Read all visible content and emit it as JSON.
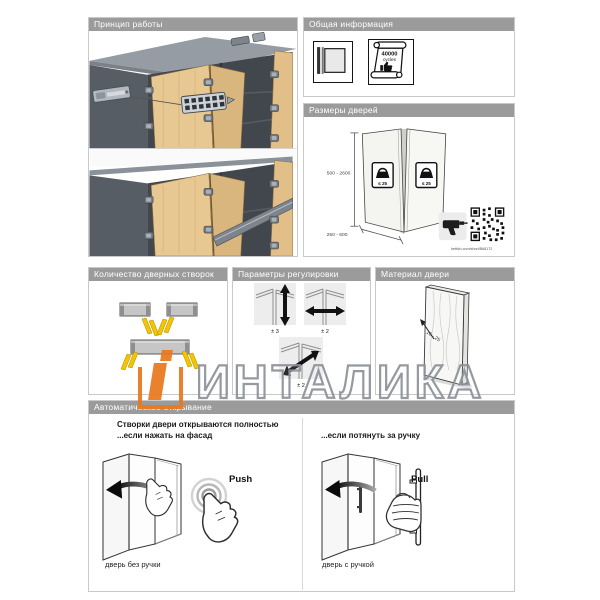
{
  "watermark": {
    "text": "ИНТАЛИКА"
  },
  "panels": {
    "principle": {
      "title": "Принцип работы"
    },
    "general": {
      "title": "Общая информация",
      "cycles_value": "40000",
      "cycles_unit": "cycles"
    },
    "sizes": {
      "title": "Размеры дверей",
      "height_range": "500 - 2600",
      "width_range": "250 - 600",
      "weight_limit": "≤ 25",
      "link": "hettich.com/short/B68172"
    },
    "leaves": {
      "title": "Количество дверных створок"
    },
    "adjust": {
      "title": "Параметры регулировки",
      "value_vertical": "± 3",
      "value_horizontal": "± 2",
      "value_diagonal": "± 2"
    },
    "material": {
      "title": "Материал двери",
      "thickness_range": "16 - 25"
    },
    "auto": {
      "title": "Автоматическое открывание",
      "headline": "Створки двери открываются полностью",
      "sub_left": "...если нажать на фасад",
      "sub_right": "...если потянуть за ручку",
      "push_label": "Push",
      "pull_label": "Pull",
      "caption_left": "дверь без ручки",
      "caption_right": "дверь с ручкой"
    }
  }
}
